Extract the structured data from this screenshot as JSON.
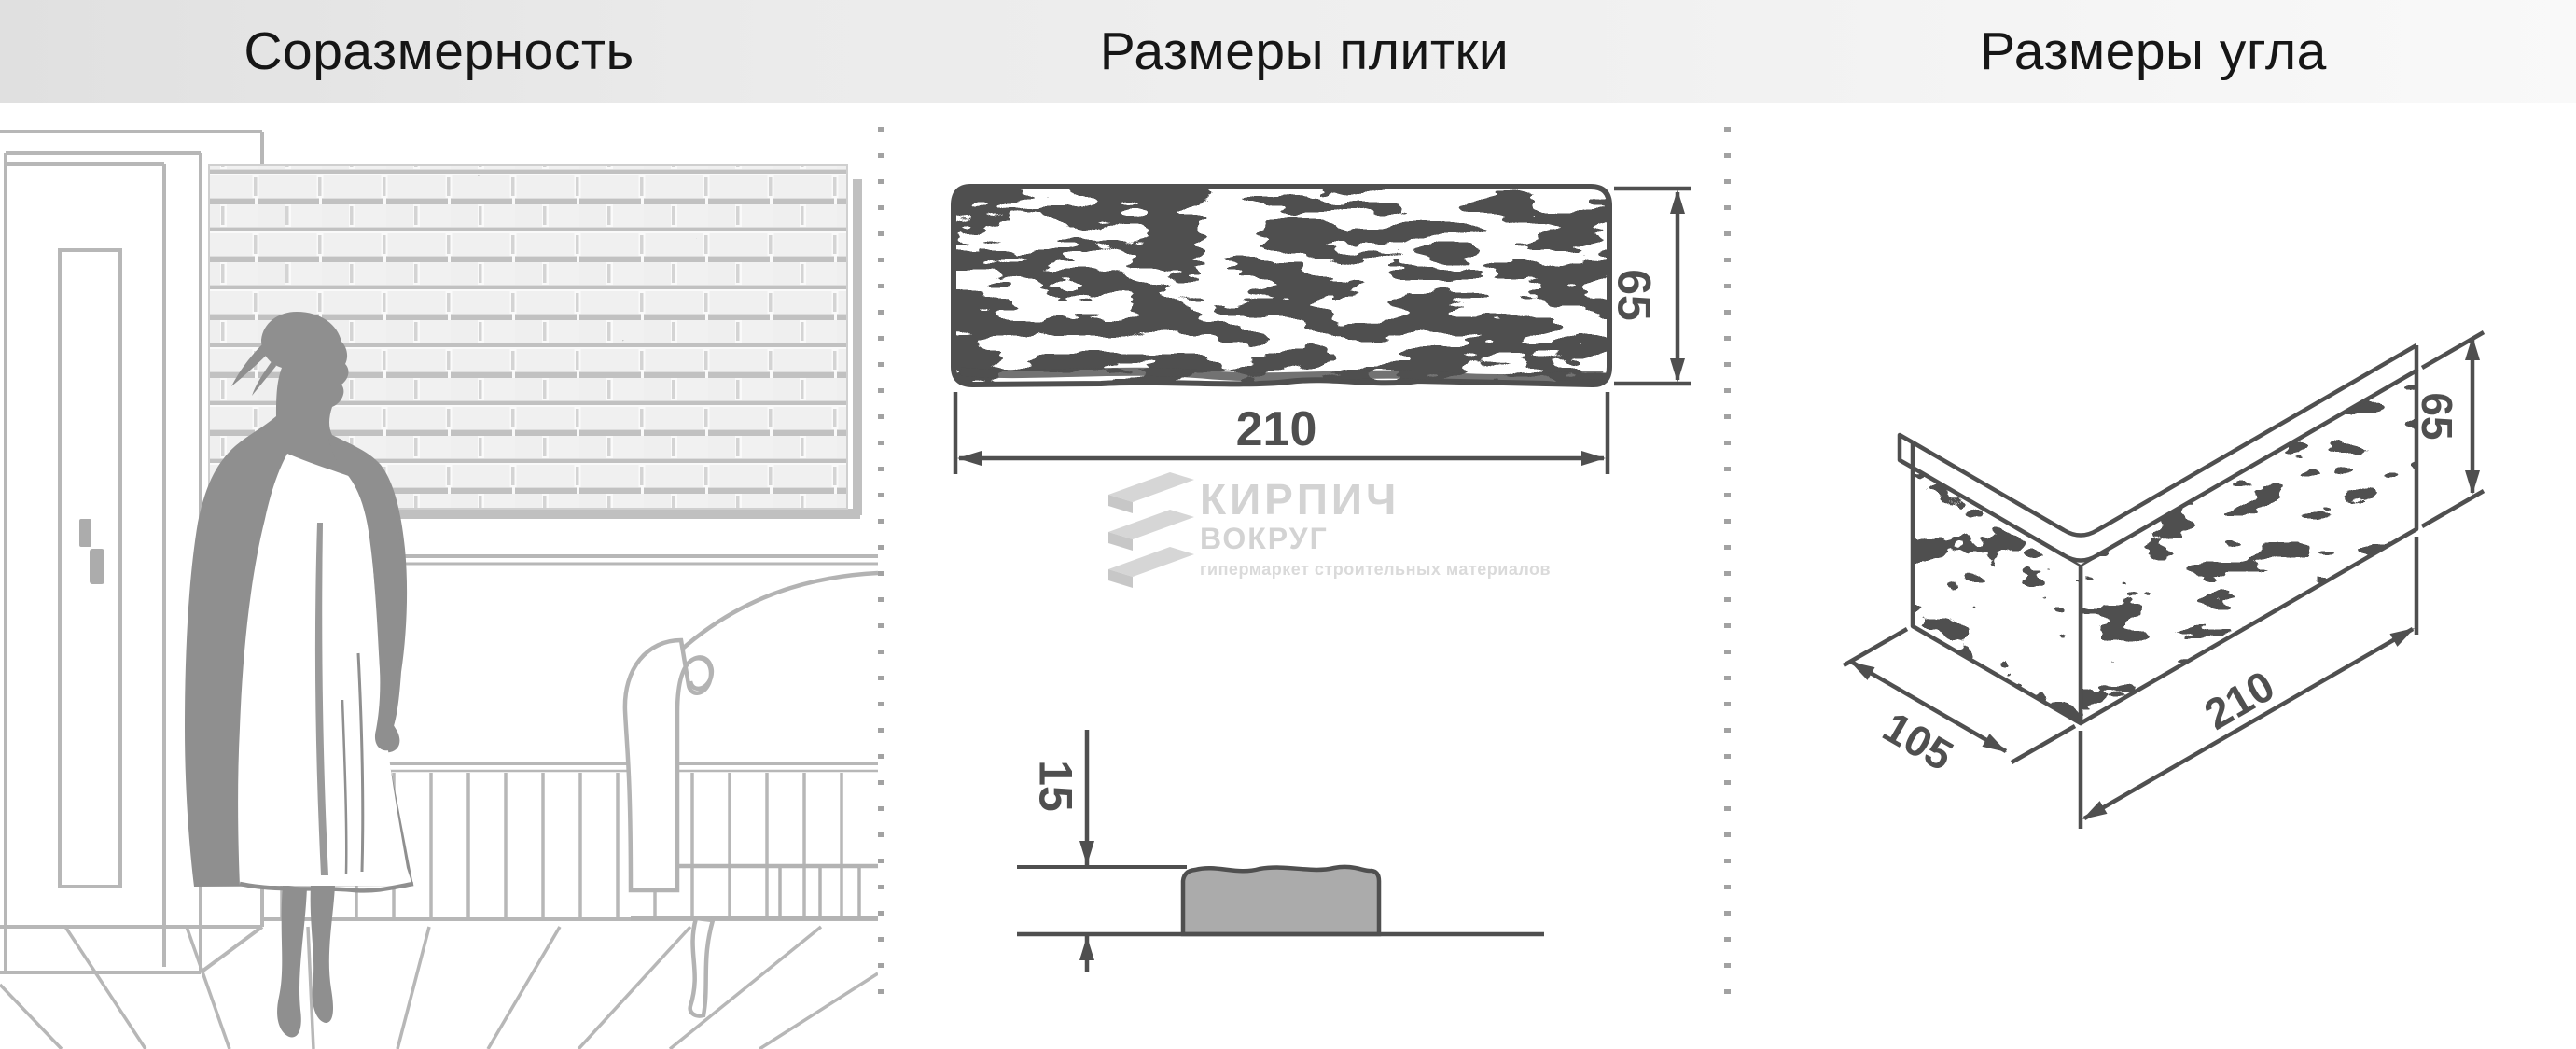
{
  "header": {
    "titles": [
      {
        "label": "Соразмерность"
      },
      {
        "label": "Размеры плитки"
      },
      {
        "label": "Размеры угла"
      }
    ]
  },
  "drawings": {
    "tile_face": {
      "width": "210",
      "height": "65"
    },
    "tile_profile": {
      "thickness": "15"
    },
    "corner": {
      "length": "210",
      "return_width": "105",
      "height": "65"
    }
  },
  "watermark": {
    "brand_top": "КИРПИЧ",
    "brand_bottom": "ВОКРУГ",
    "tagline": "гипермаркет строительных материалов"
  },
  "colors": {
    "dimension": "#4f4f4f",
    "scene_line": "#b7b7b7",
    "silhouette": "#8f8f8f",
    "watermark_gray": "#d3d3d3",
    "separator_dash": "#a2a2a2",
    "header_gradient_start": "#e0e0e0",
    "header_gradient_end": "#f9f9f9"
  }
}
